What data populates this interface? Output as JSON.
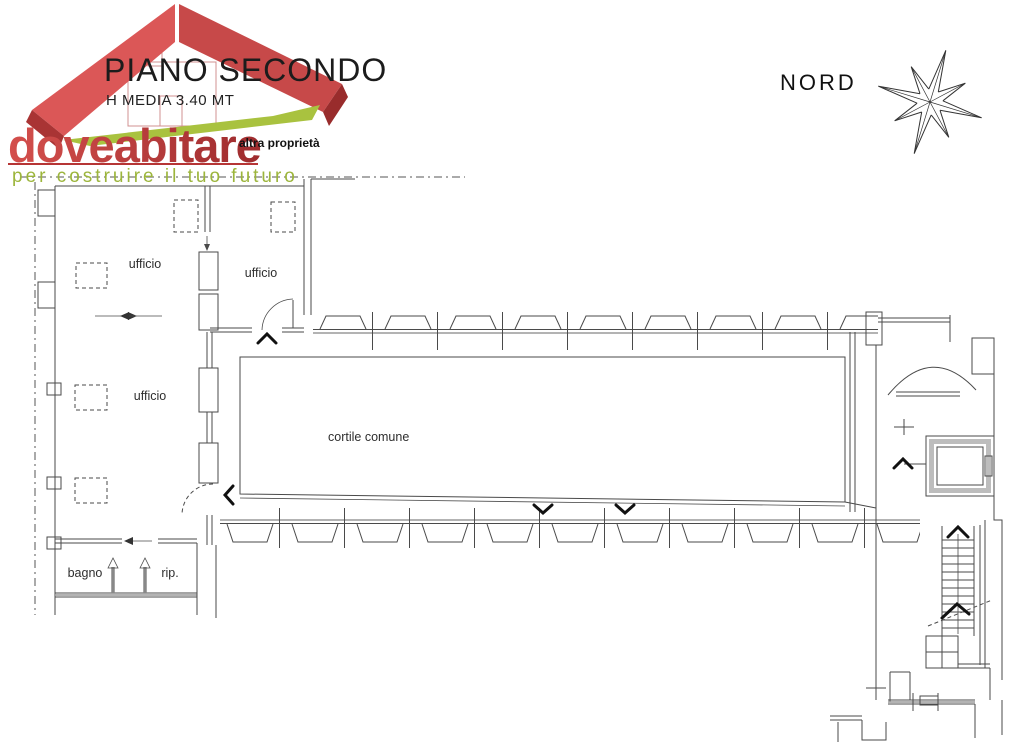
{
  "header": {
    "title": "PIANO SECONDO",
    "subtitle": "H MEDIA 3.40 MT",
    "annotation": "altra proprietà",
    "north_label": "NORD"
  },
  "logo": {
    "brand": "doveabitare",
    "tagline": "per costruire il tuo futuro",
    "brand_color": "#bf3a3a",
    "tagline_color": "#9cb53b",
    "roof_colors": [
      "#db5757",
      "#a93434",
      "#c74949",
      "#992c2c"
    ]
  },
  "plan": {
    "wall_color": "#4a4a4a",
    "window_color": "#9a9a9a",
    "labels": {
      "office_top_left": "ufficio",
      "office_top_right": "ufficio",
      "office_left": "ufficio",
      "courtyard": "cortile comune",
      "bathroom": "bagno",
      "storage": "rip."
    }
  }
}
